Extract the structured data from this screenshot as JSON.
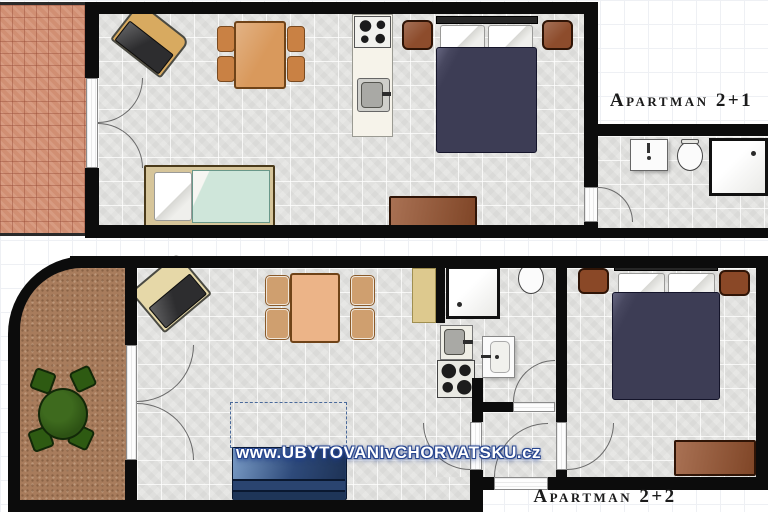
{
  "apartments": [
    {
      "label": "Apartman 2+1"
    },
    {
      "label": "Apartman 2+2"
    }
  ],
  "watermark": "www.UBYTOVANIvCHORVATSKU.cz",
  "colors": {
    "wall": "#0c0c0c",
    "floor_tile": "#e8e8e6",
    "terrace_tile": "#d18f73",
    "terrace_carpet": "#a87c5c",
    "bed_duvet": "#3d3d55",
    "dining_table_wood": "#d9995c",
    "dining_table_light": "#ecb488",
    "furniture_brown": "#96522e",
    "garden_green": "#2d5214",
    "sofa_blue": "#2e4a7a",
    "watermark_blue": "#27458f",
    "fixture_white": "#fbfbfb"
  }
}
